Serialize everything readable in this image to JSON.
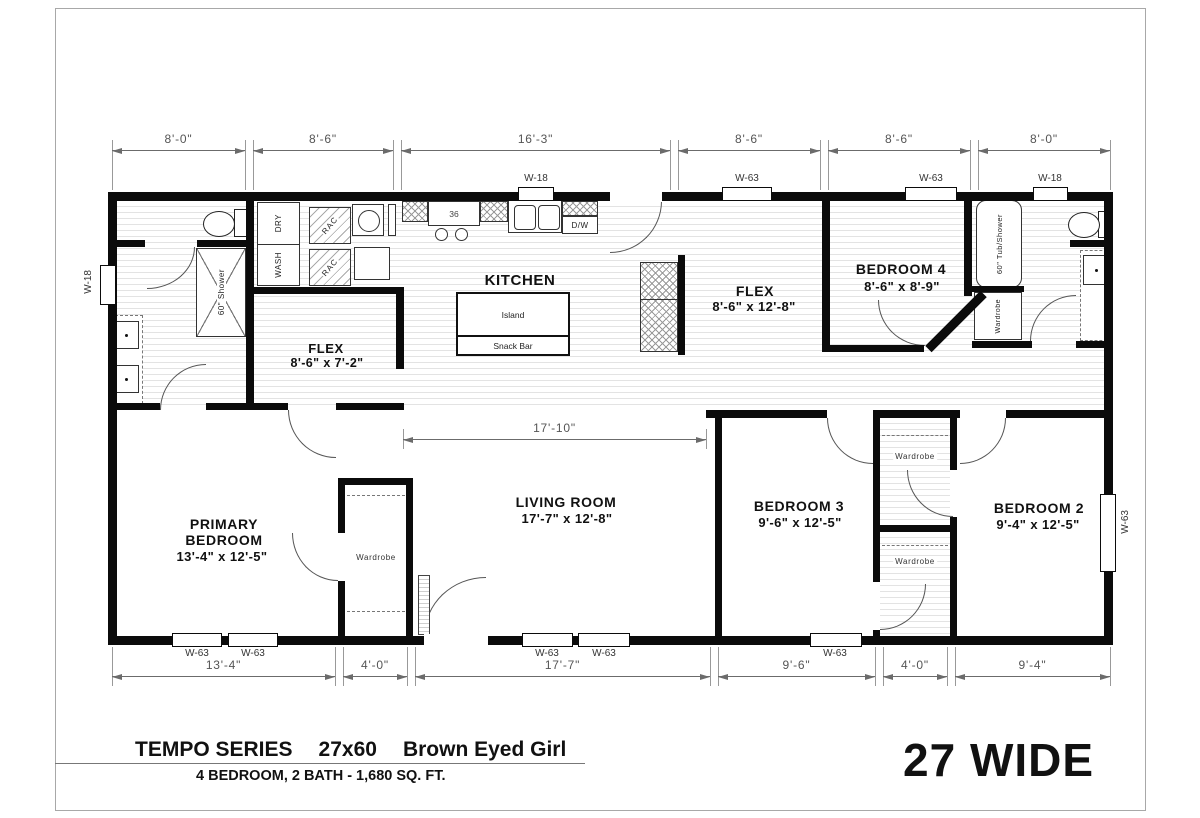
{
  "title_block": {
    "series": "TEMPO SERIES",
    "size": "27x60",
    "model": "Brown Eyed Girl",
    "subtitle": "4 BEDROOM, 2 BATH - 1,680 SQ. FT.",
    "width_label": "27 WIDE"
  },
  "rooms": {
    "kitchen": {
      "name": "KITCHEN"
    },
    "flex_front": {
      "name": "FLEX",
      "size": "8'-6\" x 7'-2\""
    },
    "flex_mid": {
      "name": "FLEX",
      "size": "8'-6\" x 12'-8\""
    },
    "bedroom4": {
      "name": "BEDROOM 4",
      "size": "8'-6\" x 8'-9\""
    },
    "living_room": {
      "name": "LIVING ROOM",
      "size": "17'-7\" x 12'-8\""
    },
    "primary_bedroom": {
      "name_line1": "PRIMARY",
      "name_line2": "BEDROOM",
      "size": "13'-4\" x 12'-5\""
    },
    "bedroom3": {
      "name": "BEDROOM 3",
      "size": "9'-6\" x 12'-5\""
    },
    "bedroom2": {
      "name": "BEDROOM 2",
      "size": "9'-4\" x 12'-5\""
    }
  },
  "fixtures": {
    "range_width": "36",
    "dishwasher": "D/W",
    "island": "Island",
    "snack_bar": "Snack Bar",
    "washer": "WASH",
    "dryer": "DRY",
    "rack": "RAC",
    "shower": "60\" Shower",
    "tub": "60\" Tub/Shower",
    "wardrobe": "Wardrobe"
  },
  "windows": {
    "top": [
      "W-18",
      "W-63",
      "W-63",
      "W-18"
    ],
    "bottom": [
      "W-63",
      "W-63",
      "W-63",
      "W-63",
      "W-63"
    ],
    "left": "W-18",
    "right": "W-63"
  },
  "dimensions": {
    "top": [
      "8'-0\"",
      "8'-6\"",
      "16'-3\"",
      "8'-6\"",
      "8'-6\"",
      "8'-0\""
    ],
    "bottom": [
      "13'-4\"",
      "4'-0\"",
      "17'-7\"",
      "9'-6\"",
      "4'-0\"",
      "9'-4\""
    ],
    "living_interior": "17'-10\""
  },
  "colors": {
    "wall": "#0b0b0b",
    "dim_line": "#6b6b6b"
  }
}
